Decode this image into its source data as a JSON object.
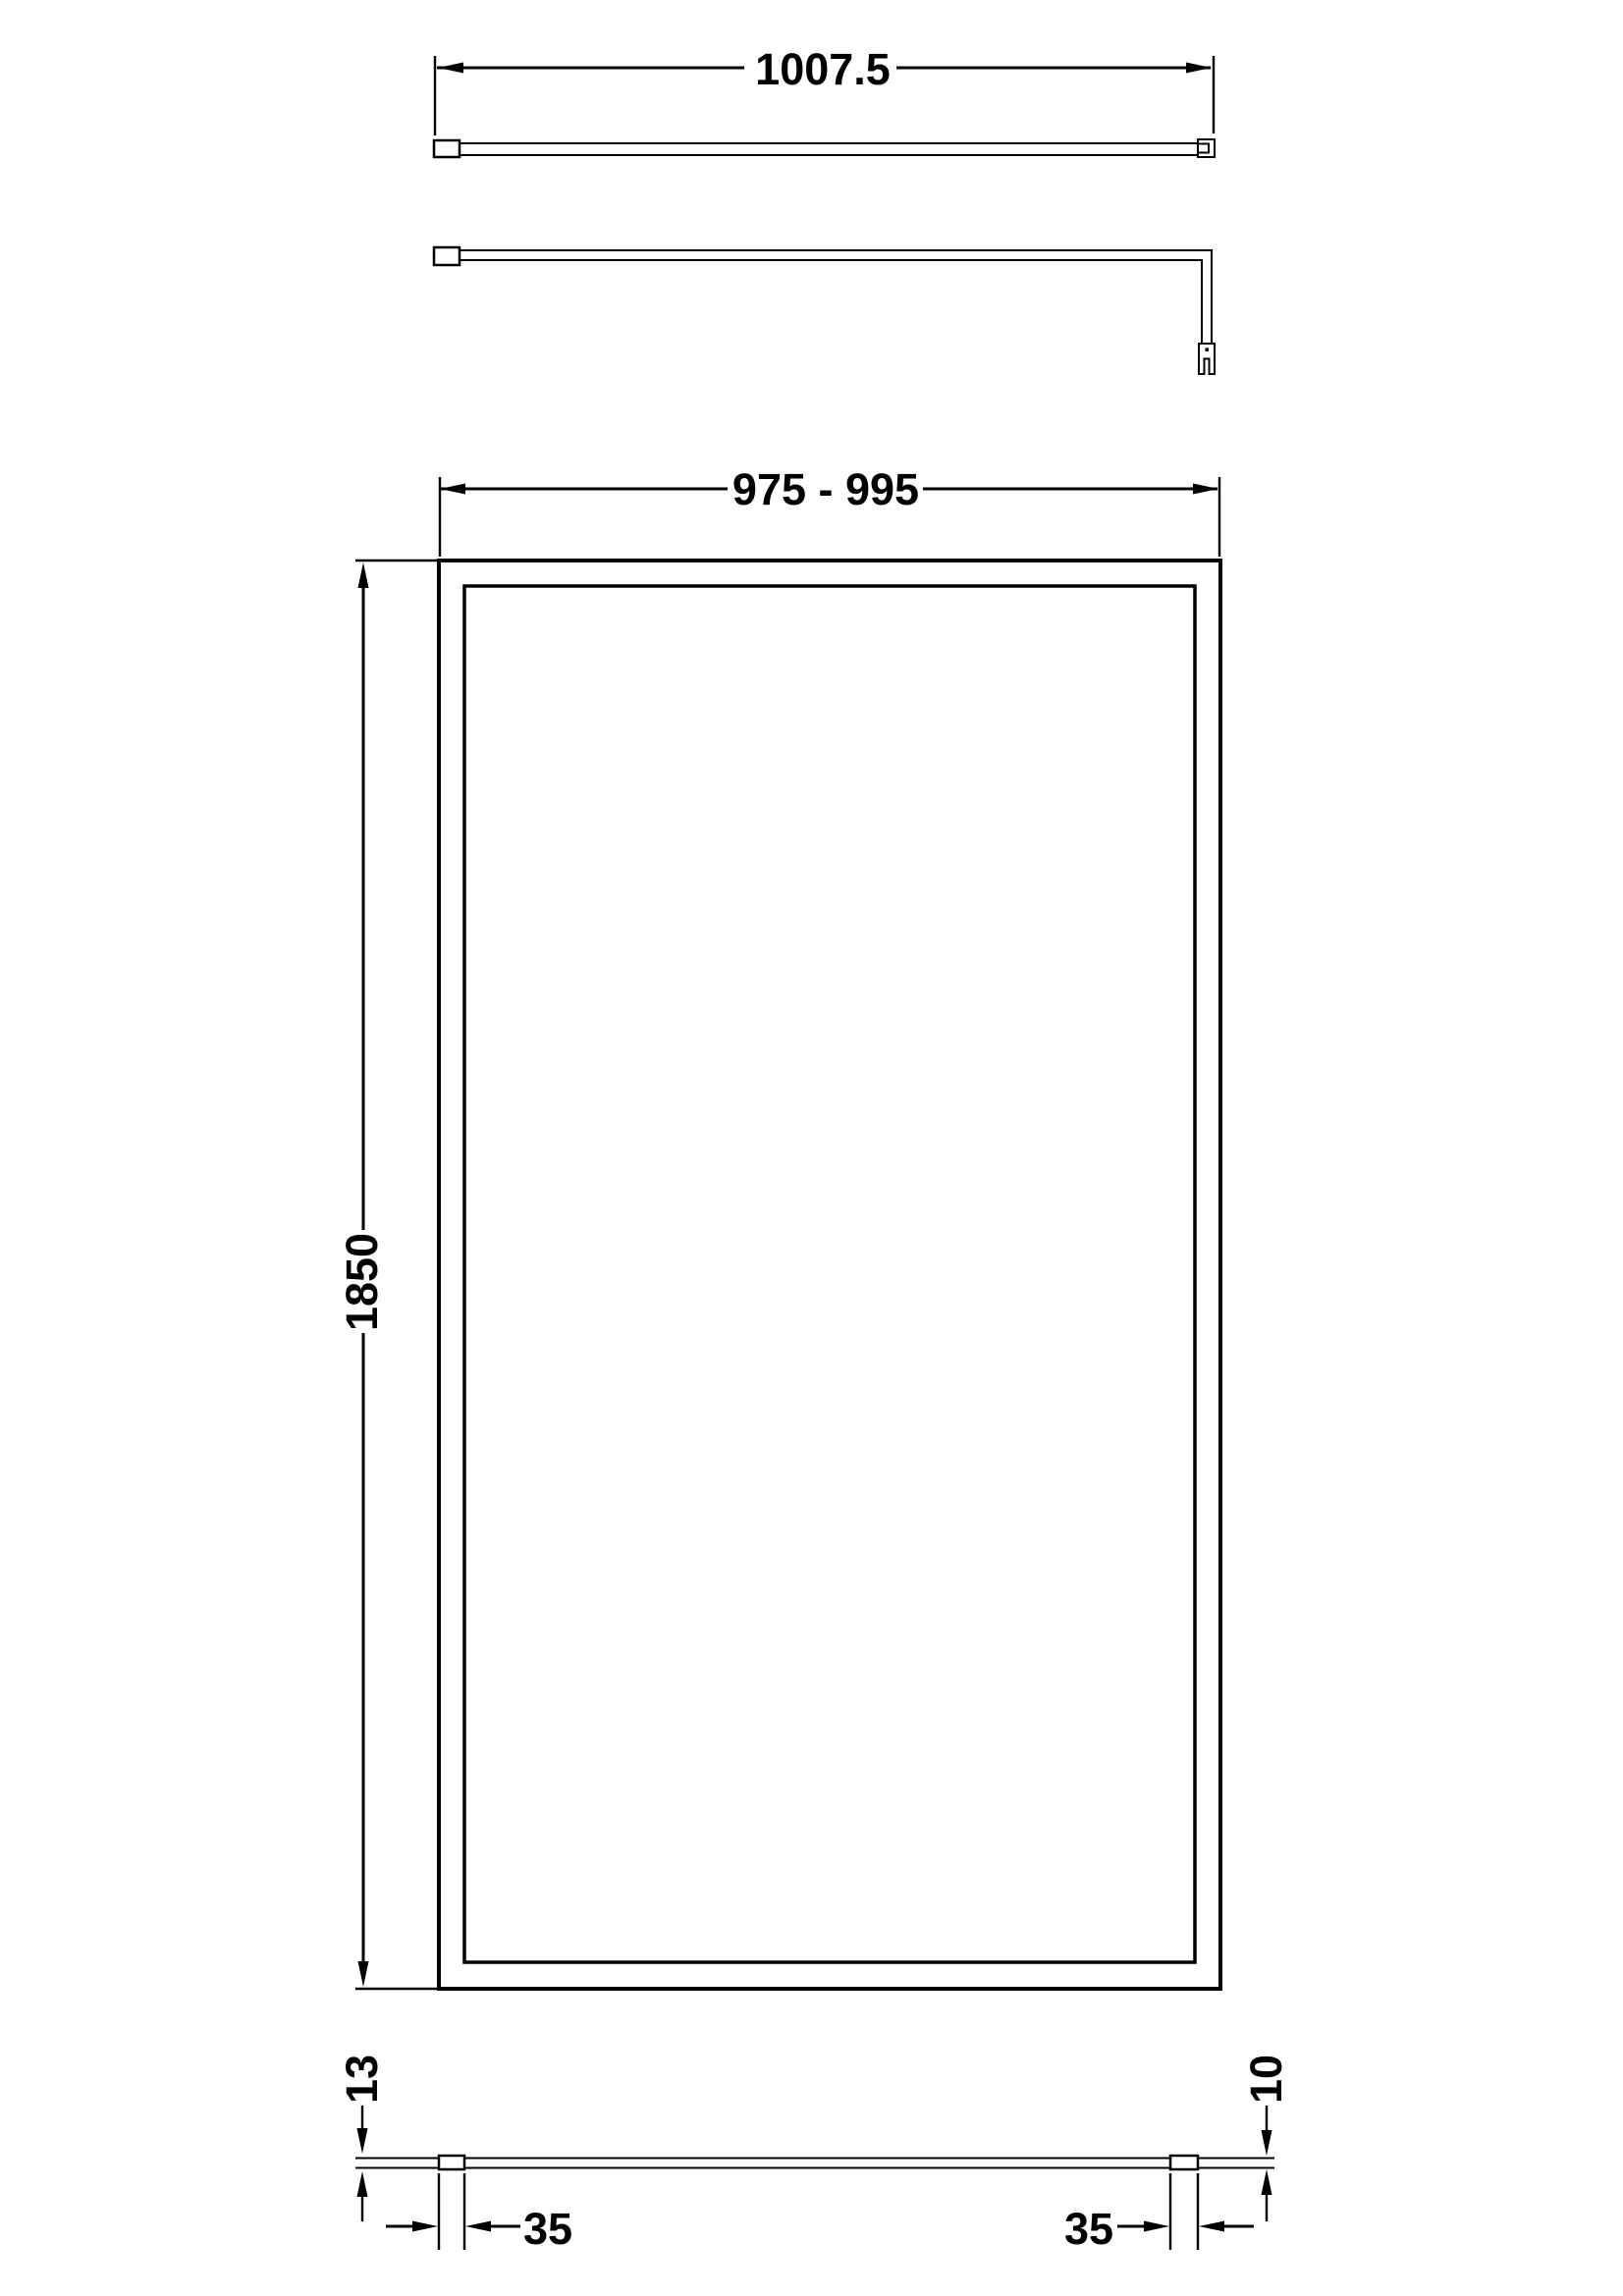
{
  "colors": {
    "background": "#ffffff",
    "line": "#000000"
  },
  "labels": {
    "bar_length": "1007.5",
    "screen_width_range": "975 - 995",
    "screen_height": "1850",
    "wall_profile_depth": "13",
    "wall_profile_width": "35",
    "foot_profile_width": "35",
    "glass_thickness": "10"
  }
}
